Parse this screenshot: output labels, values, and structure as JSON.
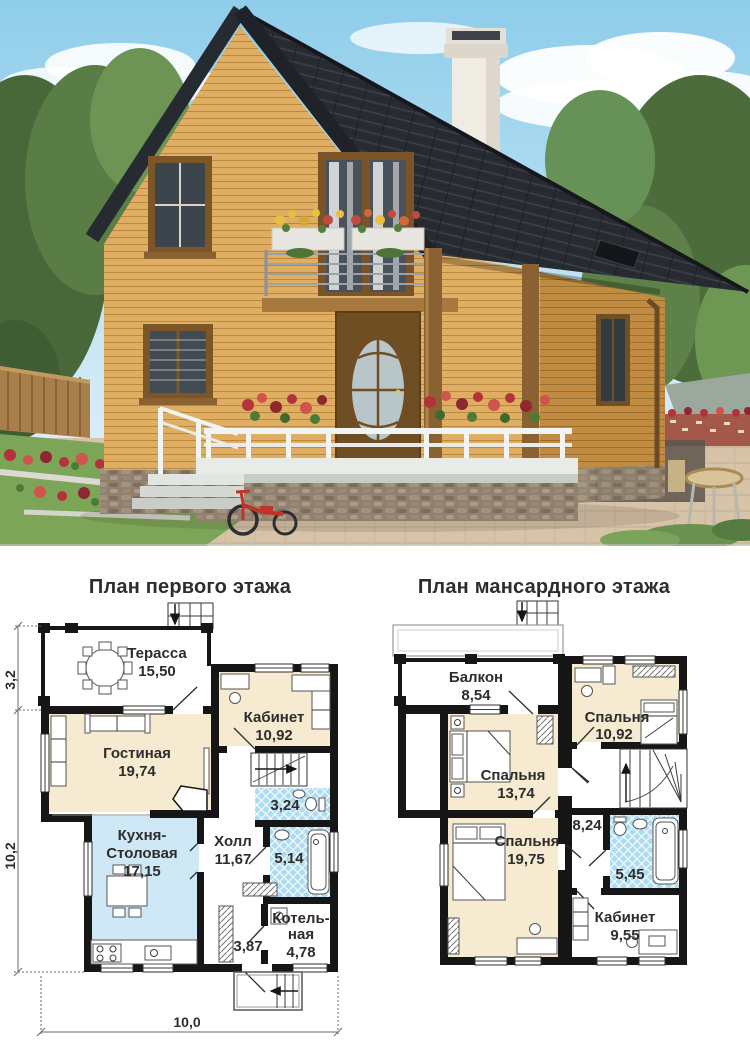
{
  "colors": {
    "plan_wall": "#161616",
    "plan_cream": "#f6ead0",
    "plan_kitchen": "#cfe8f6",
    "plan_bath": "#aedcf0",
    "plan_text": "#2d2d2d",
    "roof_dark": "#272b31",
    "wood_light": "#dfae62",
    "wood_shade": "#c18c41",
    "sky_top": "#8ecdea",
    "grass": "#7da557",
    "paving": "#d6c3a8",
    "flower_red": "#b5323c",
    "rail_white": "#f2f4f1"
  },
  "plans": {
    "first": {
      "title": "План первого этажа",
      "rooms": {
        "terrace": {
          "label": "Терасса",
          "area": "15,50"
        },
        "living": {
          "label": "Гостиная",
          "area": "19,74"
        },
        "office": {
          "label": "Кабинет",
          "area": "10,92"
        },
        "wc": {
          "area": "3,24"
        },
        "kitchen": {
          "label_line1": "Кухня-",
          "label_line2": "Столовая",
          "area": "17,15"
        },
        "hall": {
          "label": "Холл",
          "area": "11,67"
        },
        "bathroom": {
          "area": "5,14"
        },
        "corridor": {
          "area": "3,87"
        },
        "boiler": {
          "label_line1": "Котель-",
          "label_line2": "ная",
          "area": "4,78"
        }
      },
      "dimensions": {
        "terrace_depth": "3,2",
        "house_depth": "10,2",
        "house_width": "10,0"
      }
    },
    "attic": {
      "title": "План мансардного этажа",
      "rooms": {
        "balcony": {
          "label": "Балкон",
          "area": "8,54"
        },
        "bedroom_small": {
          "label": "Спальня",
          "area": "10,92"
        },
        "bedroom_mid": {
          "label": "Спальня",
          "area": "13,74"
        },
        "hall": {
          "area": "8,24"
        },
        "bedroom_large": {
          "label": "Спальня",
          "area": "19,75"
        },
        "bathroom": {
          "area": "5,45"
        },
        "office": {
          "label": "Кабинет",
          "area": "9,55"
        }
      }
    }
  }
}
